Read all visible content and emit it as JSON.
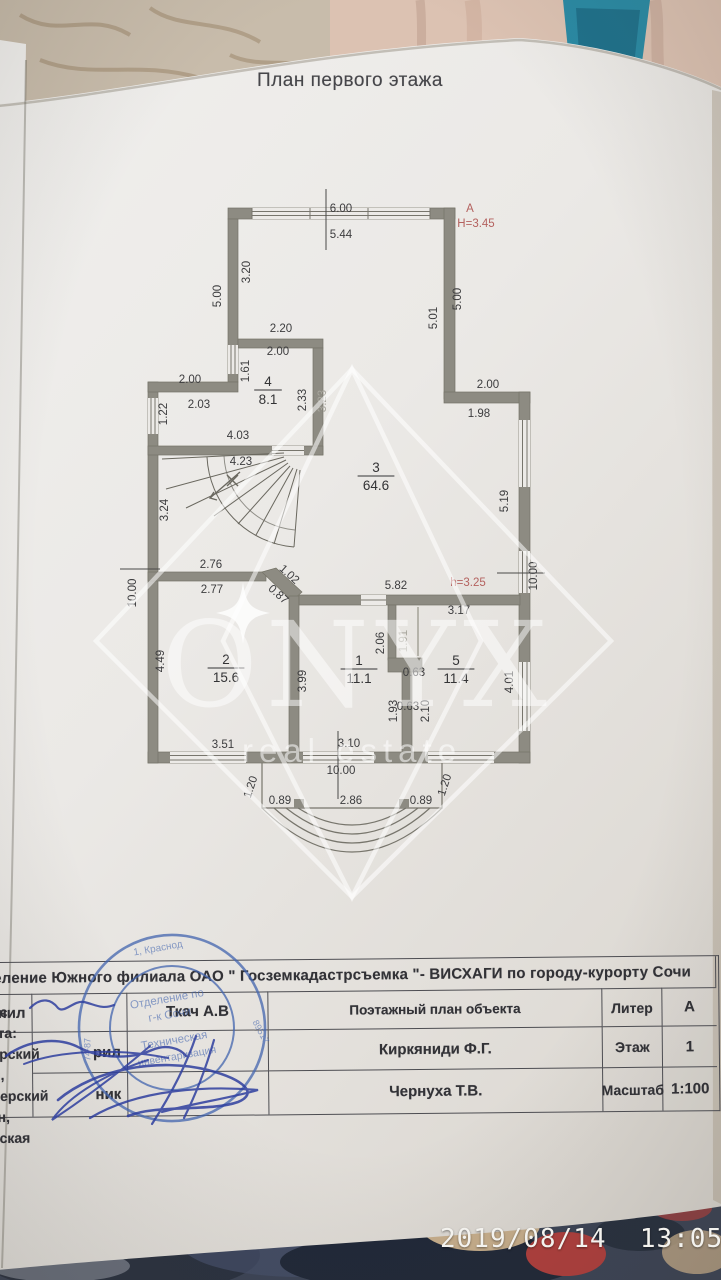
{
  "title": "План первого этажа",
  "watermark": {
    "brand": "ONYX",
    "sub": "real estate"
  },
  "camera": {
    "timestamp": "2019/08/14  13:05"
  },
  "plan": {
    "labels": [
      {
        "t": "6.00",
        "x": 341,
        "y": 212
      },
      {
        "t": "5.44",
        "x": 341,
        "y": 238
      },
      {
        "t": "А",
        "x": 470,
        "y": 212,
        "c": "red"
      },
      {
        "t": "H=3.45",
        "x": 476,
        "y": 227,
        "c": "red"
      },
      {
        "t": "3.20",
        "x": 250,
        "y": 272,
        "r": -90
      },
      {
        "t": "5.00",
        "x": 221,
        "y": 296,
        "r": -90
      },
      {
        "t": "5.01",
        "x": 437,
        "y": 318,
        "r": -90
      },
      {
        "t": "5.00",
        "x": 461,
        "y": 299,
        "r": -90
      },
      {
        "t": "2.20",
        "x": 281,
        "y": 332
      },
      {
        "t": "2.00",
        "x": 278,
        "y": 355
      },
      {
        "t": "1.61",
        "x": 249,
        "y": 371,
        "r": -90
      },
      {
        "t": "2.00",
        "x": 190,
        "y": 383
      },
      {
        "t": "2.03",
        "x": 199,
        "y": 408
      },
      {
        "t": "1.22",
        "x": 167,
        "y": 414,
        "r": -90
      },
      {
        "t": "2.33",
        "x": 306,
        "y": 400,
        "r": -90
      },
      {
        "t": "3.23",
        "x": 326,
        "y": 401,
        "r": -90,
        "c": "faint"
      },
      {
        "t": "2.00",
        "x": 488,
        "y": 388
      },
      {
        "t": "1.98",
        "x": 479,
        "y": 417
      },
      {
        "t": "4.03",
        "x": 238,
        "y": 439
      },
      {
        "t": "4.23",
        "x": 241,
        "y": 465
      },
      {
        "t": "3.24",
        "x": 168,
        "y": 510,
        "r": -90
      },
      {
        "t": "5.19",
        "x": 508,
        "y": 501,
        "r": -90
      },
      {
        "t": "10.00",
        "x": 136,
        "y": 593,
        "r": -90
      },
      {
        "t": "2.76",
        "x": 211,
        "y": 568
      },
      {
        "t": "2.77",
        "x": 212,
        "y": 593
      },
      {
        "t": "1.02",
        "x": 287,
        "y": 577,
        "r": 42
      },
      {
        "t": "0.87",
        "x": 276,
        "y": 597,
        "r": 42
      },
      {
        "t": "5.82",
        "x": 396,
        "y": 589
      },
      {
        "t": "h=3.25",
        "x": 468,
        "y": 586,
        "c": "red"
      },
      {
        "t": "10.00",
        "x": 537,
        "y": 576,
        "r": -90
      },
      {
        "t": "3.17",
        "x": 459,
        "y": 614
      },
      {
        "t": "2.06",
        "x": 384,
        "y": 643,
        "r": -90
      },
      {
        "t": "1.91",
        "x": 407,
        "y": 641,
        "r": -90,
        "c": "faint"
      },
      {
        "t": "0.63",
        "x": 414,
        "y": 676
      },
      {
        "t": "0.63",
        "x": 408,
        "y": 710
      },
      {
        "t": "4.49",
        "x": 164,
        "y": 661,
        "r": -90
      },
      {
        "t": "3.99",
        "x": 306,
        "y": 681,
        "r": -90
      },
      {
        "t": "1.93",
        "x": 397,
        "y": 711,
        "r": -90
      },
      {
        "t": "2.10",
        "x": 429,
        "y": 711,
        "r": -90
      },
      {
        "t": "4.01",
        "x": 513,
        "y": 682,
        "r": -90
      },
      {
        "t": "3.51",
        "x": 223,
        "y": 748
      },
      {
        "t": "3.10",
        "x": 349,
        "y": 747
      },
      {
        "t": "10.00",
        "x": 341,
        "y": 774
      },
      {
        "t": "0.89",
        "x": 280,
        "y": 804
      },
      {
        "t": "2.86",
        "x": 351,
        "y": 804
      },
      {
        "t": "0.89",
        "x": 421,
        "y": 804
      },
      {
        "t": "1.20",
        "x": 254,
        "y": 788,
        "r": -72
      },
      {
        "t": "1.20",
        "x": 448,
        "y": 786,
        "r": -72
      }
    ],
    "rooms": [
      {
        "n": "4",
        "a": "8.1",
        "x": 268,
        "y": 386
      },
      {
        "n": "3",
        "a": "64.6",
        "x": 376,
        "y": 472
      },
      {
        "n": "2",
        "a": "15.6",
        "x": 226,
        "y": 664
      },
      {
        "n": "1",
        "a": "11.1",
        "x": 359,
        "y": 665
      },
      {
        "n": "5",
        "a": "11.4",
        "x": 456,
        "y": 665
      }
    ]
  },
  "table": {
    "org_header": "Отделение Южного филиала ОАО \" Госземкадастрсъемка \"- ВИСХАГИ по городу-курорту Сочи",
    "rows_left": [
      "нил",
      "рил",
      "ник"
    ],
    "names": [
      "Ткач А.В",
      "Киркяниди Ф.Г.",
      "Чернуха Т.В."
    ],
    "doc_type": "Поэтажный план объекта",
    "address_label": "Адрес объекта:",
    "address_line1": "Краснодарский край, г.Сочи,Адлерский район,",
    "address_line2": "ул.Брянская",
    "attr1_label": "Литер",
    "attr1_value": "А",
    "attr2_label": "Этаж",
    "attr2_value": "1",
    "attr3_label": "Масштаб",
    "attr3_value": "1:100"
  },
  "stamp": {
    "line1": "Отделение по",
    "line2": "г-к Сочи",
    "line3": "Техническая",
    "line4": "инвентаризация",
    "ring_text": "1, Краснод",
    "num_left": "74-87",
    "num_right": "89517"
  },
  "colors": {
    "stamp_blue": "#4365af",
    "annotation_red": "#b4625f",
    "wall_gray": "#8d8b82",
    "paper": "#edebe8"
  }
}
